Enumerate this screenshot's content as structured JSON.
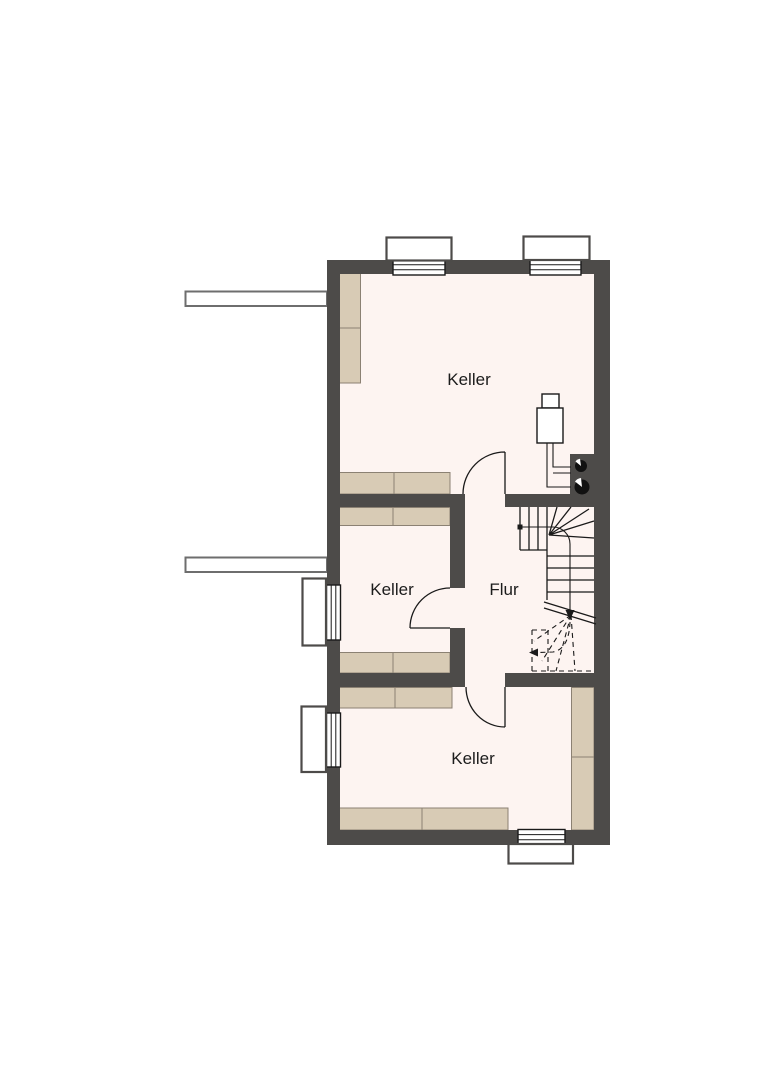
{
  "plan": {
    "rooms": [
      {
        "name": "keller-top",
        "label": "Keller"
      },
      {
        "name": "keller-middle",
        "label": "Keller"
      },
      {
        "name": "flur",
        "label": "Flur"
      },
      {
        "name": "keller-bottom",
        "label": "Keller"
      }
    ]
  },
  "colors": {
    "canvas": "#ffffff",
    "wall": "#4d4b49",
    "room-fill": "#fdf4f1",
    "furniture": "#d8cbb5",
    "furniture-border": "#8b8173",
    "line": "#1a1a1a",
    "shaft-border": "#6e6e6e"
  }
}
